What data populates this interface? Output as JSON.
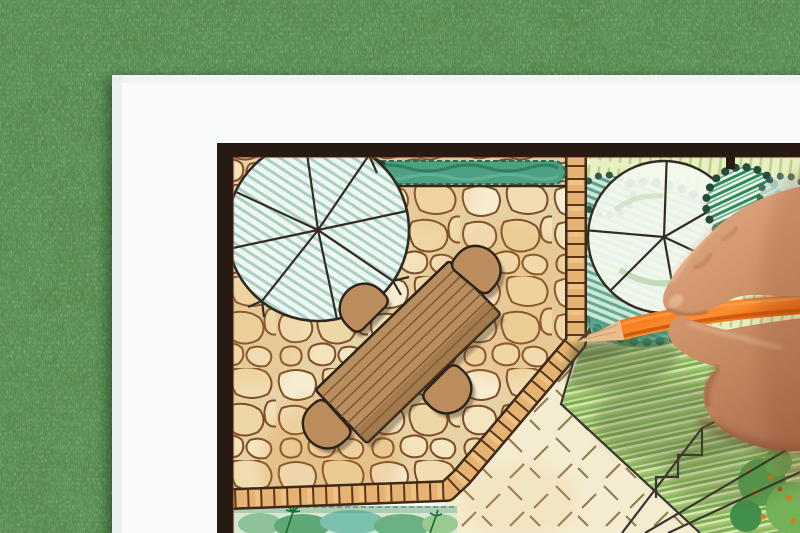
{
  "scene": {
    "type": "photograph",
    "subject": "hand drawing a garden landscape architecture plan with an orange colored pencil",
    "background": "green grass lawn",
    "paper": "white sheet with dark-framed landscape plan drawing"
  },
  "palette": {
    "grass_base": "#4d8040",
    "paper": "#f8fafb",
    "plan_frame": "#261a12",
    "stone_fill": "#f3e4c0",
    "stone_outline": "#7d4e28",
    "grout": "#e7d2a6",
    "tile_border": "#e6b272",
    "tile_rung": "#5a3517",
    "lawn_yellow": "#e9efc4",
    "lawn_green_stripe": "#7dac53",
    "lawn_dash": "#97774b",
    "tree_hatch_teal": "#a7d1c3",
    "bush_teal": "#58a387",
    "bush_dark_green": "#2e8a5a",
    "hedge_green": "#4ea083",
    "furniture_wood": "#b98e5e",
    "outline_ink": "#332c22",
    "pencil_orange": "#f0741e",
    "pencil_wood": "#ecbe8d",
    "pencil_tip": "#4e4038",
    "skin_mid": "#c98d68",
    "skin_shadow": "#8d5a3e",
    "skin_highlight": "#e8bb97"
  },
  "plan_elements": {
    "trees": 2,
    "chairs": 4,
    "tables": 1,
    "hedges": 1,
    "areas": [
      "flagstone patio",
      "tile border path",
      "yellow-green lawn",
      "striped green lawn",
      "planting beds"
    ]
  },
  "foreground": {
    "hand": "right hand holding pencil",
    "pencil_color": "orange"
  }
}
